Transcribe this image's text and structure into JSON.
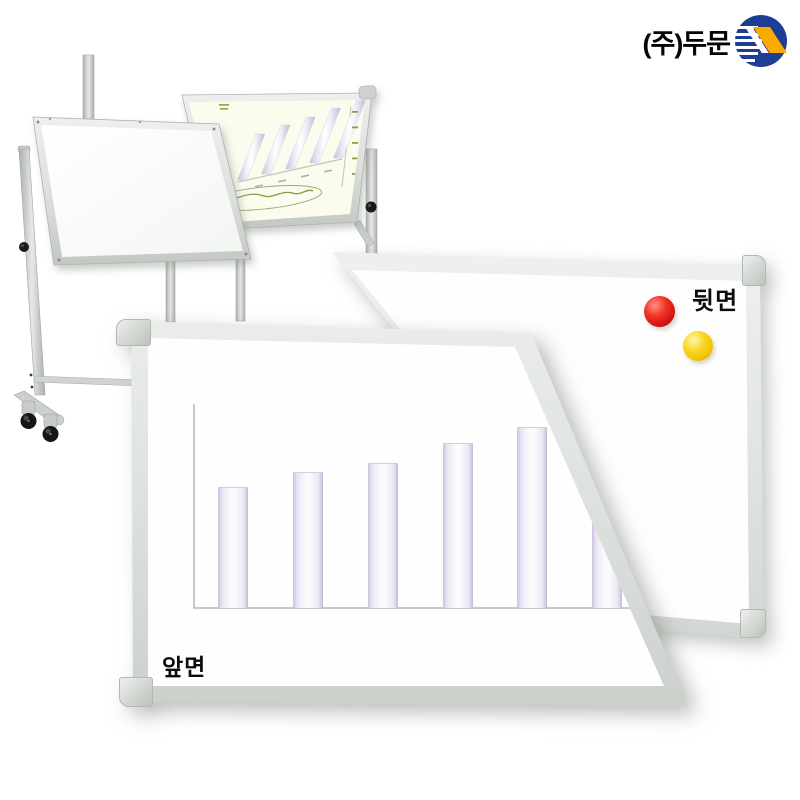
{
  "logo": {
    "company_text": "(주)두문",
    "icon_circle_color": "#1e3e95",
    "icon_shape_color": "#f9ab00"
  },
  "back_board": {
    "label": "뒷면",
    "magnets": [
      {
        "name": "red-magnet",
        "color": "#d31111"
      },
      {
        "name": "yellow-magnet",
        "color": "#f0c903"
      }
    ]
  },
  "front_board": {
    "label": "앞면",
    "chart": {
      "type": "bar",
      "bar_width": 30,
      "baseline_y": 607,
      "baseline_length": 450,
      "axis_x": 193,
      "axis_top": 404,
      "axis_color": "#c7ccc2",
      "bar_edge_color": "#c9c2dc",
      "bars": [
        {
          "x": 218,
          "height": 120
        },
        {
          "x": 293,
          "height": 135
        },
        {
          "x": 368,
          "height": 144
        },
        {
          "x": 443,
          "height": 164
        },
        {
          "x": 517,
          "height": 180
        },
        {
          "x": 592,
          "height": 92
        }
      ]
    }
  },
  "stand_chart": {
    "type": "bar",
    "bar_width": 9,
    "lean": 0.4,
    "bars": [
      {
        "x": 242,
        "y": 180,
        "h": 46
      },
      {
        "x": 266,
        "y": 174,
        "h": 49
      },
      {
        "x": 290,
        "y": 169,
        "h": 52
      },
      {
        "x": 314,
        "y": 163,
        "h": 55
      },
      {
        "x": 338,
        "y": 158,
        "h": 58
      }
    ],
    "ticks": {
      "x": 352,
      "y": 111,
      "step": 15.5,
      "count": 5,
      "color": "#86a24a"
    },
    "xmarks": [
      {
        "x": 255,
        "y": 186
      },
      {
        "x": 278,
        "y": 181
      },
      {
        "x": 301,
        "y": 176
      },
      {
        "x": 324,
        "y": 171
      }
    ],
    "annotation_color": "#7f9f3f"
  }
}
